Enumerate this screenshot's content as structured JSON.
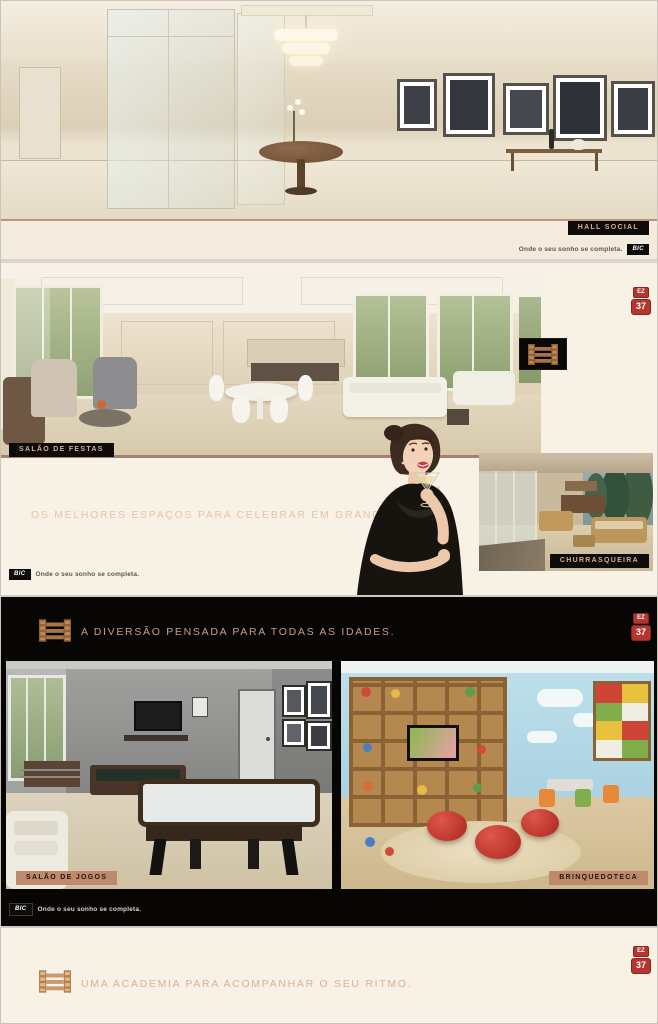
{
  "brand": {
    "logo": "BIC",
    "slogan": "Onde o seu sonho se completa.",
    "badge": {
      "top": "EZ",
      "bottom": "37"
    }
  },
  "icons": {
    "ladder": "ladder-monogram-icon",
    "badge": "ez37-seal-icon",
    "bic": "bic-logo"
  },
  "colors": {
    "cream_bg": "#f6efe3",
    "black_bg": "#070605",
    "label_dark_bg": "#0e0c0a",
    "label_dark_text": "#d9ae95",
    "label_tan_bg": "#bd8a6e",
    "headline_tan": "#e5c4ab",
    "headline_on_black": "#c69e8a",
    "badge_red": "#b5362f",
    "icon_bronze": "#a5744b"
  },
  "sections": {
    "hall_social": {
      "label": "HALL SOCIAL"
    },
    "salao_festas": {
      "label": "SALÃO DE FESTAS",
      "headline": "OS MELHORES ESPAÇOS PARA CELEBRAR EM GRANDE ESTILO.",
      "churrasqueira": {
        "label": "CHURRASQUEIRA"
      }
    },
    "diversao": {
      "headline": "A DIVERSÃO PENSADA PARA TODAS AS IDADES.",
      "salao_jogos": {
        "label": "SALÃO DE JOGOS"
      },
      "brinquedoteca": {
        "label": "BRINQUEDOTECA"
      }
    },
    "academia": {
      "headline": "UMA ACADEMIA PARA ACOMPANHAR O SEU RITMO."
    }
  }
}
